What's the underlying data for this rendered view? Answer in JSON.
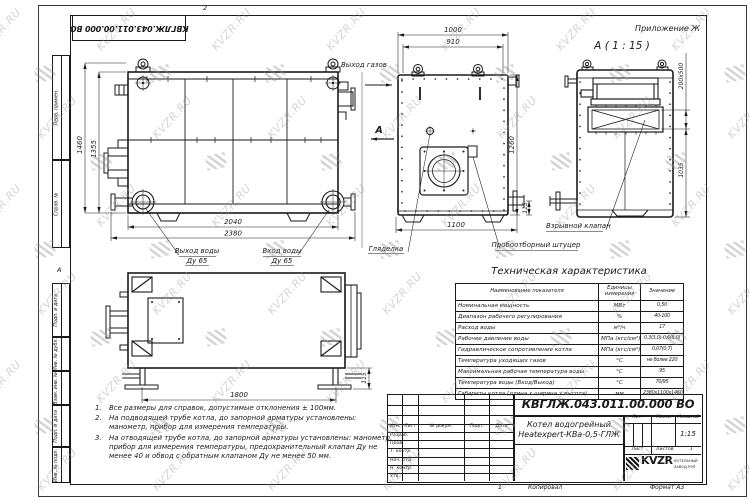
{
  "sheet": {
    "designation_mirror": "КВГЛЖ.043.011.00.000 ВО",
    "zone_top": "2",
    "zone_left": "А",
    "margin_labels": [
      "Перв. примен.",
      "Справ. №",
      "Подп. и дата",
      "Инв. № дубл.",
      "Взам. инв. №",
      "Подп. и дата",
      "Инв. № подл."
    ],
    "annex_label": "Приложение Ж"
  },
  "views": {
    "side": {
      "dim_h_outer": "1460",
      "dim_h_inner": "1355",
      "dim_w_inner": "2040",
      "dim_w_outer": "2380",
      "label_gas_out": "Выход газов",
      "label_water_out": "Выход воды",
      "label_water_out_dn": "Ду 65",
      "label_water_in": "Вход воды",
      "label_water_in_dn": "Ду 65",
      "view_arrow": "А"
    },
    "front": {
      "dim_w1": "1000",
      "dim_w2": "910",
      "dim_h": "1260",
      "dim_pipe": "115",
      "dim_w3": "1100",
      "label_sight": "Гляделка",
      "label_sampler": "Пробоотборный штуцер"
    },
    "detail": {
      "title": "А ( 1 : 15 )",
      "dim_valve": "200х500",
      "dim_h": "1035",
      "label_valve": "Взрывной клапан"
    },
    "bottom": {
      "dim_feet": "1800",
      "dim_foot_h": "115"
    }
  },
  "spec_table": {
    "title": "Техническая характеристика",
    "col_name": "Наименование показателя",
    "col_units": "Единицы измерения",
    "col_value": "Значение",
    "rows": [
      {
        "name": "Номинальная мощность",
        "units": "МВт",
        "value": "0,50"
      },
      {
        "name": "Диапазон рабочего регулирования",
        "units": "%",
        "value": "40-100"
      },
      {
        "name": "Расход воды",
        "units": "м³/ч",
        "value": "17"
      },
      {
        "name": "Рабочее давление воды",
        "units": "МПа (кгс/см²)",
        "value": "0,3(3,0)-0,6(6,0)"
      },
      {
        "name": "Гидравлическое сопротивление котла",
        "units": "МПа (кгс/см²)",
        "value": "0,07(0,7)"
      },
      {
        "name": "Температура уходящих газов",
        "units": "°С",
        "value": "не более 220"
      },
      {
        "name": "Максимальная рабочая температура воды",
        "units": "°С",
        "value": "95"
      },
      {
        "name": "Температура воды (Вход/Выход)",
        "units": "°С",
        "value": "70/95"
      },
      {
        "name": "Габариты котла (длина х ширина х высота)",
        "units": "мм",
        "value": "2380х1100х1460"
      }
    ]
  },
  "notes": [
    {
      "num": "1.",
      "text": "Все размеры для справок, допустимые отклонения ± 100мм."
    },
    {
      "num": "2.",
      "text": "На подводящей трубе котла, до запорной арматуры установлены: манометр, прибор для измерения температуры."
    },
    {
      "num": "3.",
      "text": "На отводящей трубе котла, до запорной арматуры установлены: манометр, прибор для измерения температуры, предохранительный клапан Ду не менее 40 и обвод с обратным клапаном Ду не менее 50 мм."
    }
  ],
  "stamp": {
    "designation": "КВГЛЖ.043.011.00.000 ВО",
    "name_line1": "Котел водогрейный",
    "name_line2": "Heatexpert-КВа-0,5-ГЛЖ",
    "cols": [
      "Изм.",
      "Лист",
      "№ докум.",
      "Подп.",
      "Дата"
    ],
    "rows": [
      "Разраб.",
      "Пров.",
      "Т. контр.",
      "Нач. отд.",
      "Н. контр.",
      "Утв."
    ],
    "lit": "Лит.",
    "mass": "Масса",
    "scale": "Масштаб",
    "scale_value": "1:15",
    "sheet": "Лист",
    "sheets": "Листов",
    "sheets_value": "1",
    "logo_text": "KVZR",
    "logo_sub1": "КОТЕЛЬНЫЙ",
    "logo_sub2": "ЗАВОД РЭП",
    "copied": "Копировал",
    "format": "Формат А3",
    "copy_num": "1"
  },
  "watermark": {
    "text": "KVZR.RU"
  }
}
